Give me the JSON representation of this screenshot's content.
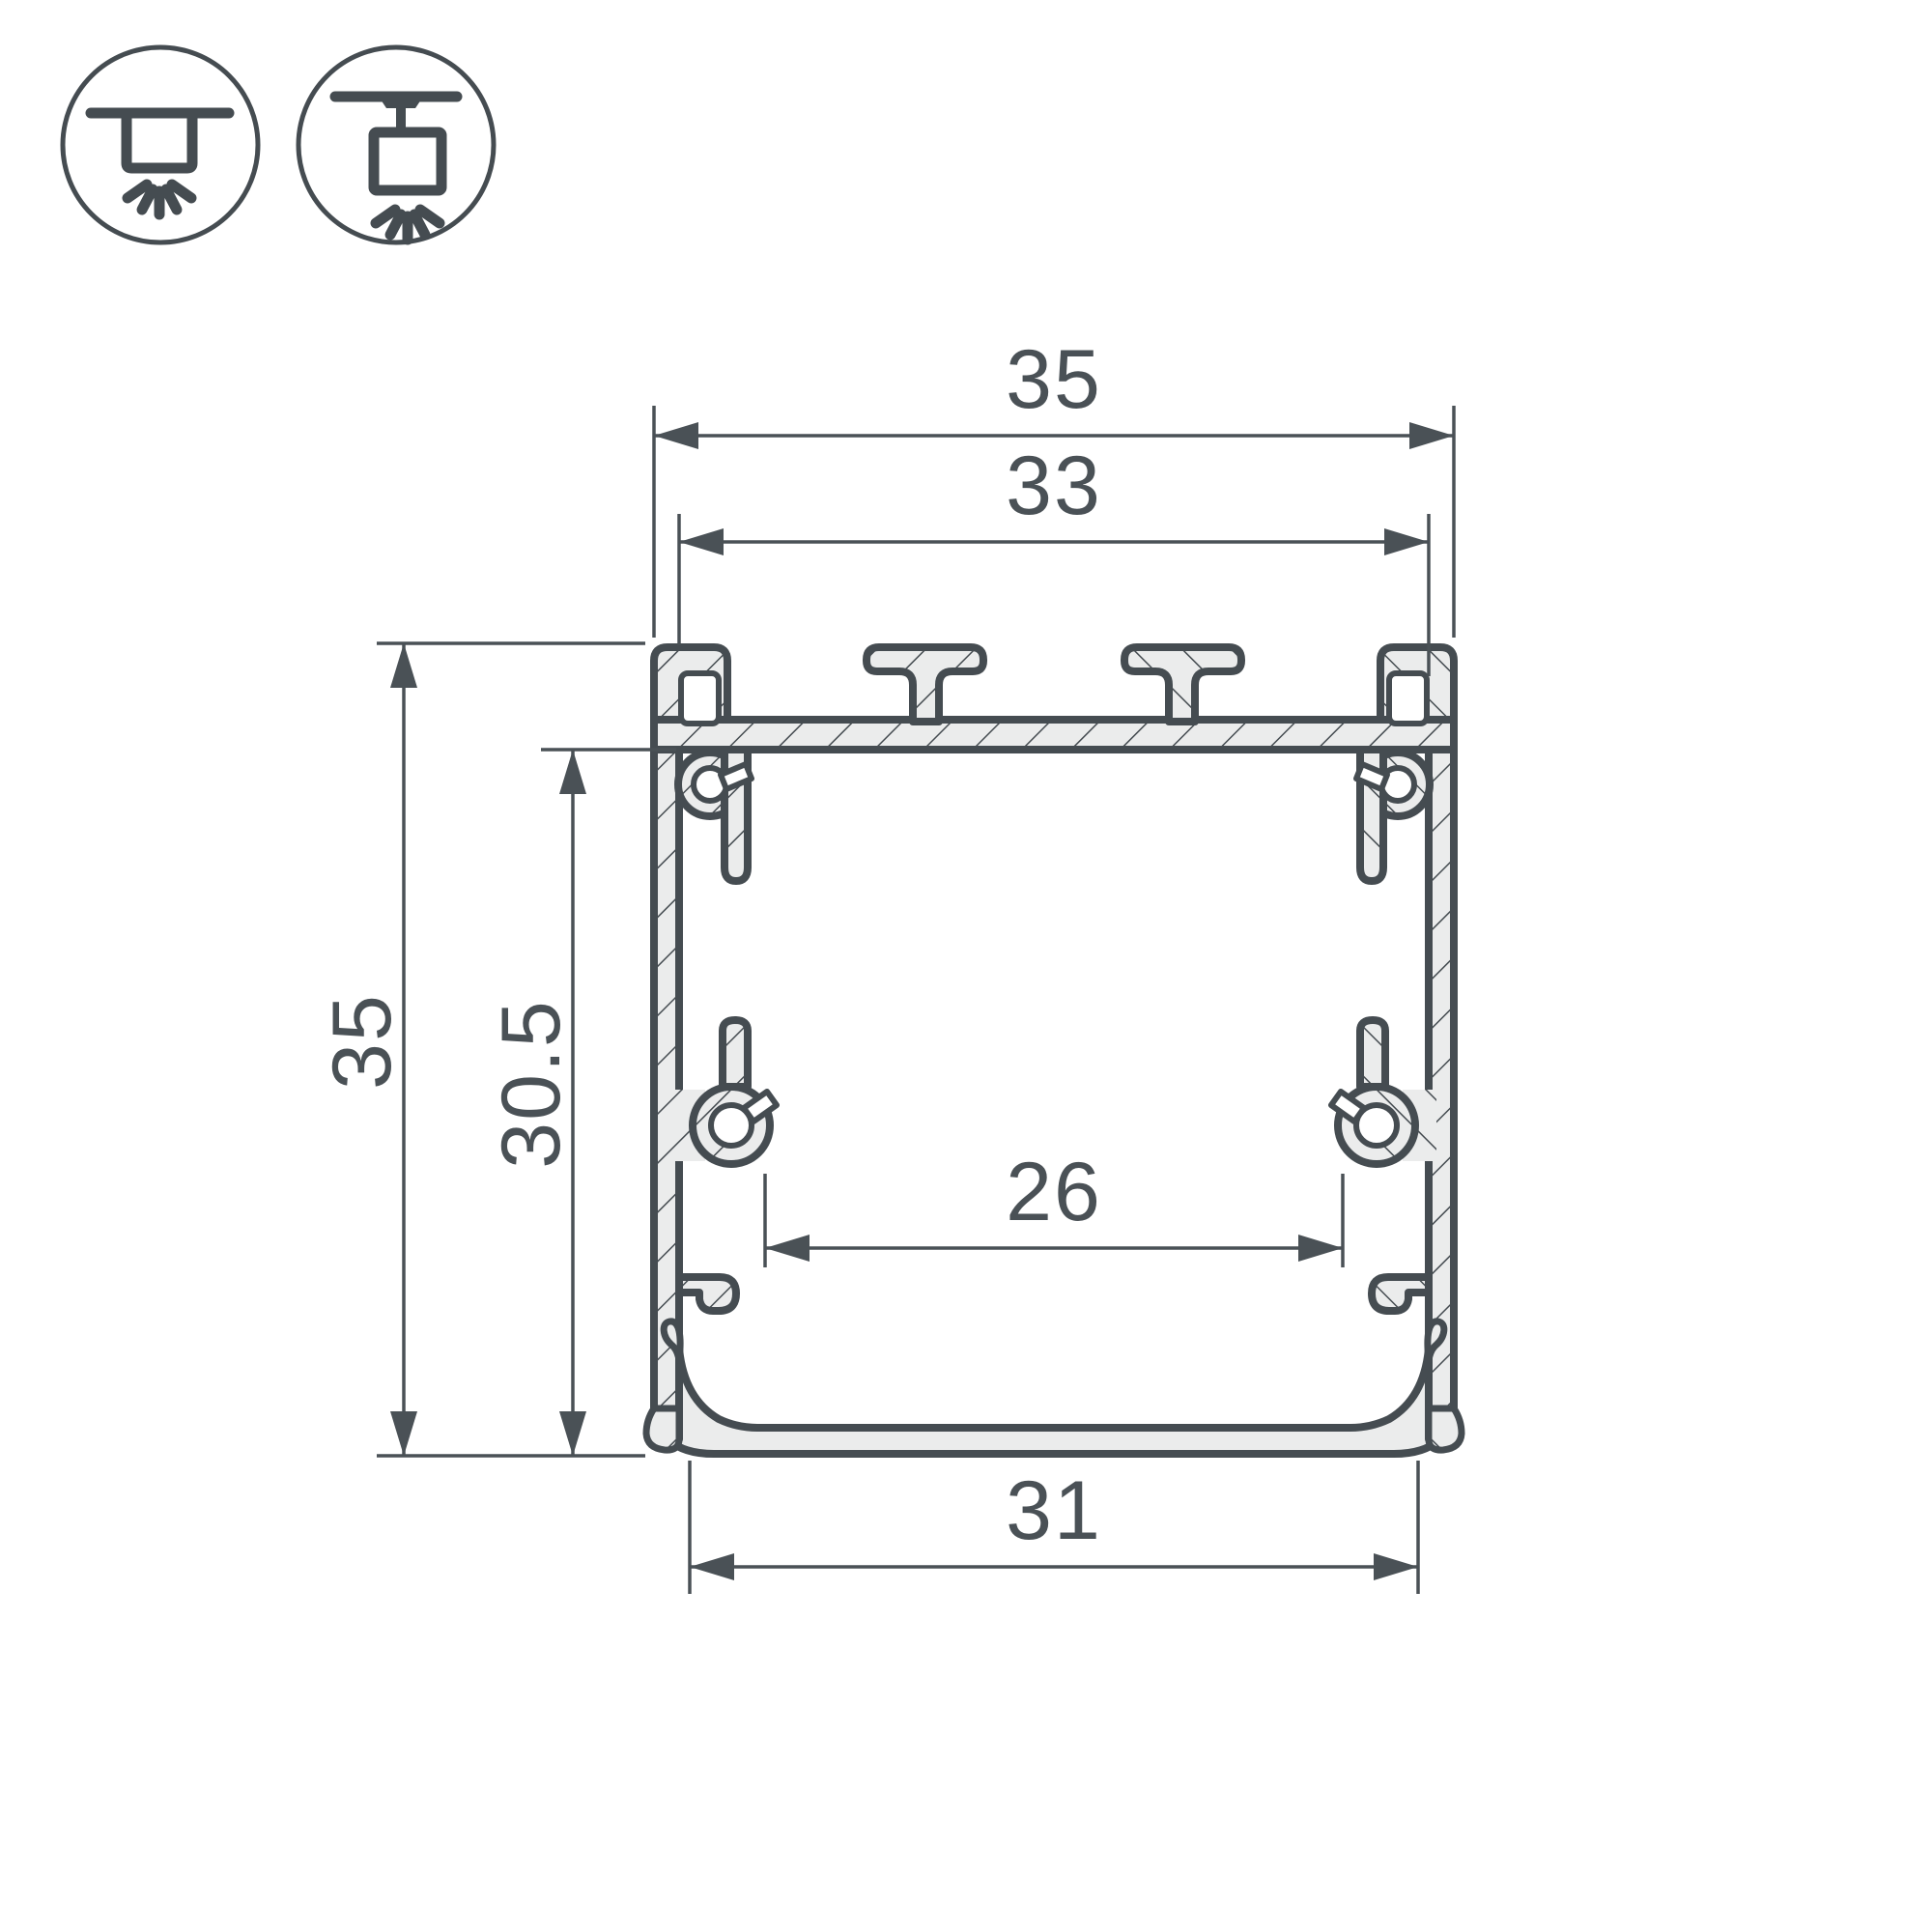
{
  "colors": {
    "background": "#ffffff",
    "line": "#454C51",
    "material_fill": "#EBECEC",
    "dimension": "#4A5156"
  },
  "icons": {
    "left": "surface-mount-light-icon",
    "right": "pendant-mount-light-icon"
  },
  "dimensions": {
    "top_overall_width": "35",
    "top_inner_width": "33",
    "overall_height": "35",
    "inner_height": "30.5",
    "inner_slot_width": "26",
    "bottom_width": "31"
  }
}
